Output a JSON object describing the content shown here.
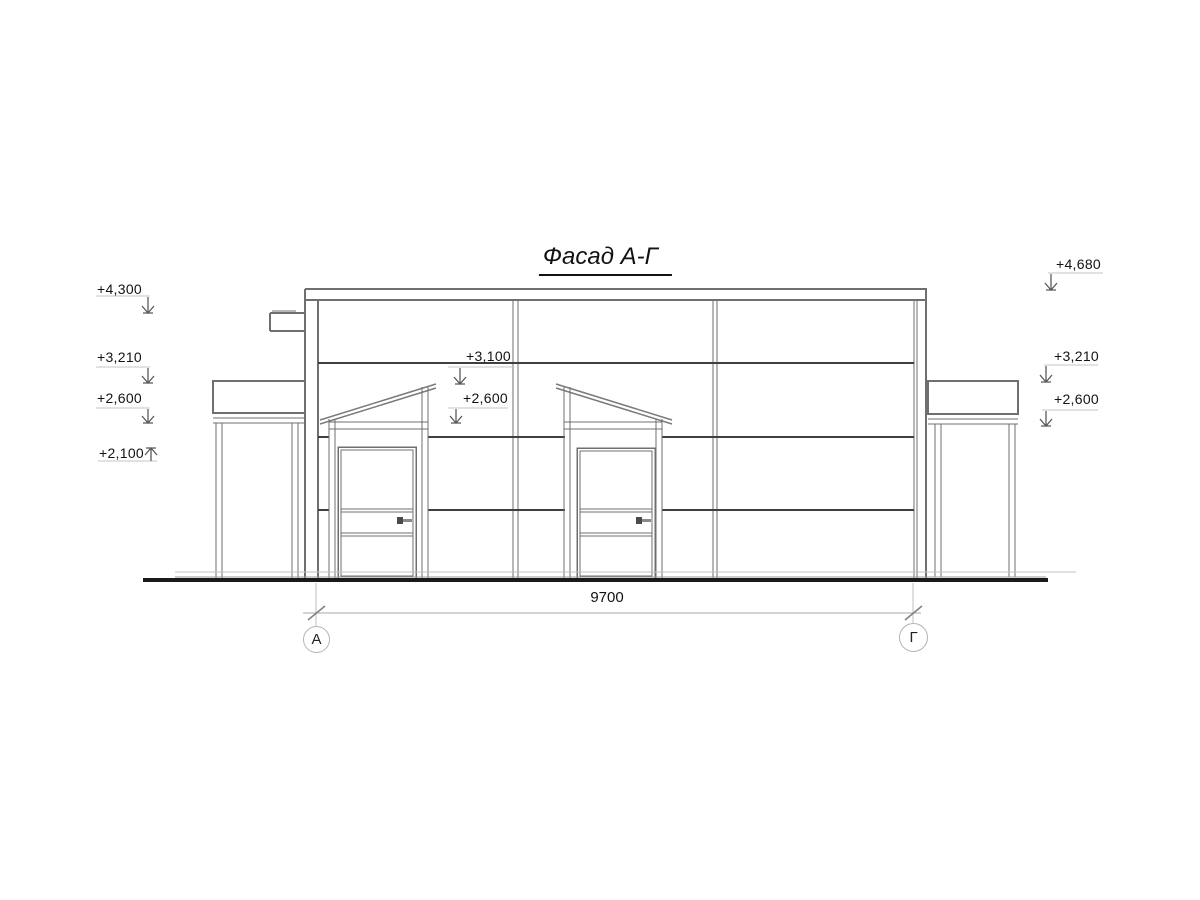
{
  "title": "Фасад А-Г",
  "drawing_type": "facade-elevation",
  "dimension": {
    "value": "9700"
  },
  "axes": {
    "left": "А",
    "right": "Г"
  },
  "elevation_marks": {
    "left": [
      {
        "value": "+4,300"
      },
      {
        "value": "+3,210"
      },
      {
        "value": "+2,600"
      },
      {
        "value": "+2,100"
      }
    ],
    "center": [
      {
        "value": "+3,100"
      },
      {
        "value": "+2,600"
      }
    ],
    "right": [
      {
        "value": "+4,680"
      },
      {
        "value": "+3,210"
      },
      {
        "value": "+2,600"
      }
    ]
  },
  "colors": {
    "line_medium": "#6f6f6f",
    "line_dark": "#3f3f3f",
    "ground": "#1a1a1a",
    "line_light": "#b8b8b8",
    "text": "#121212"
  }
}
